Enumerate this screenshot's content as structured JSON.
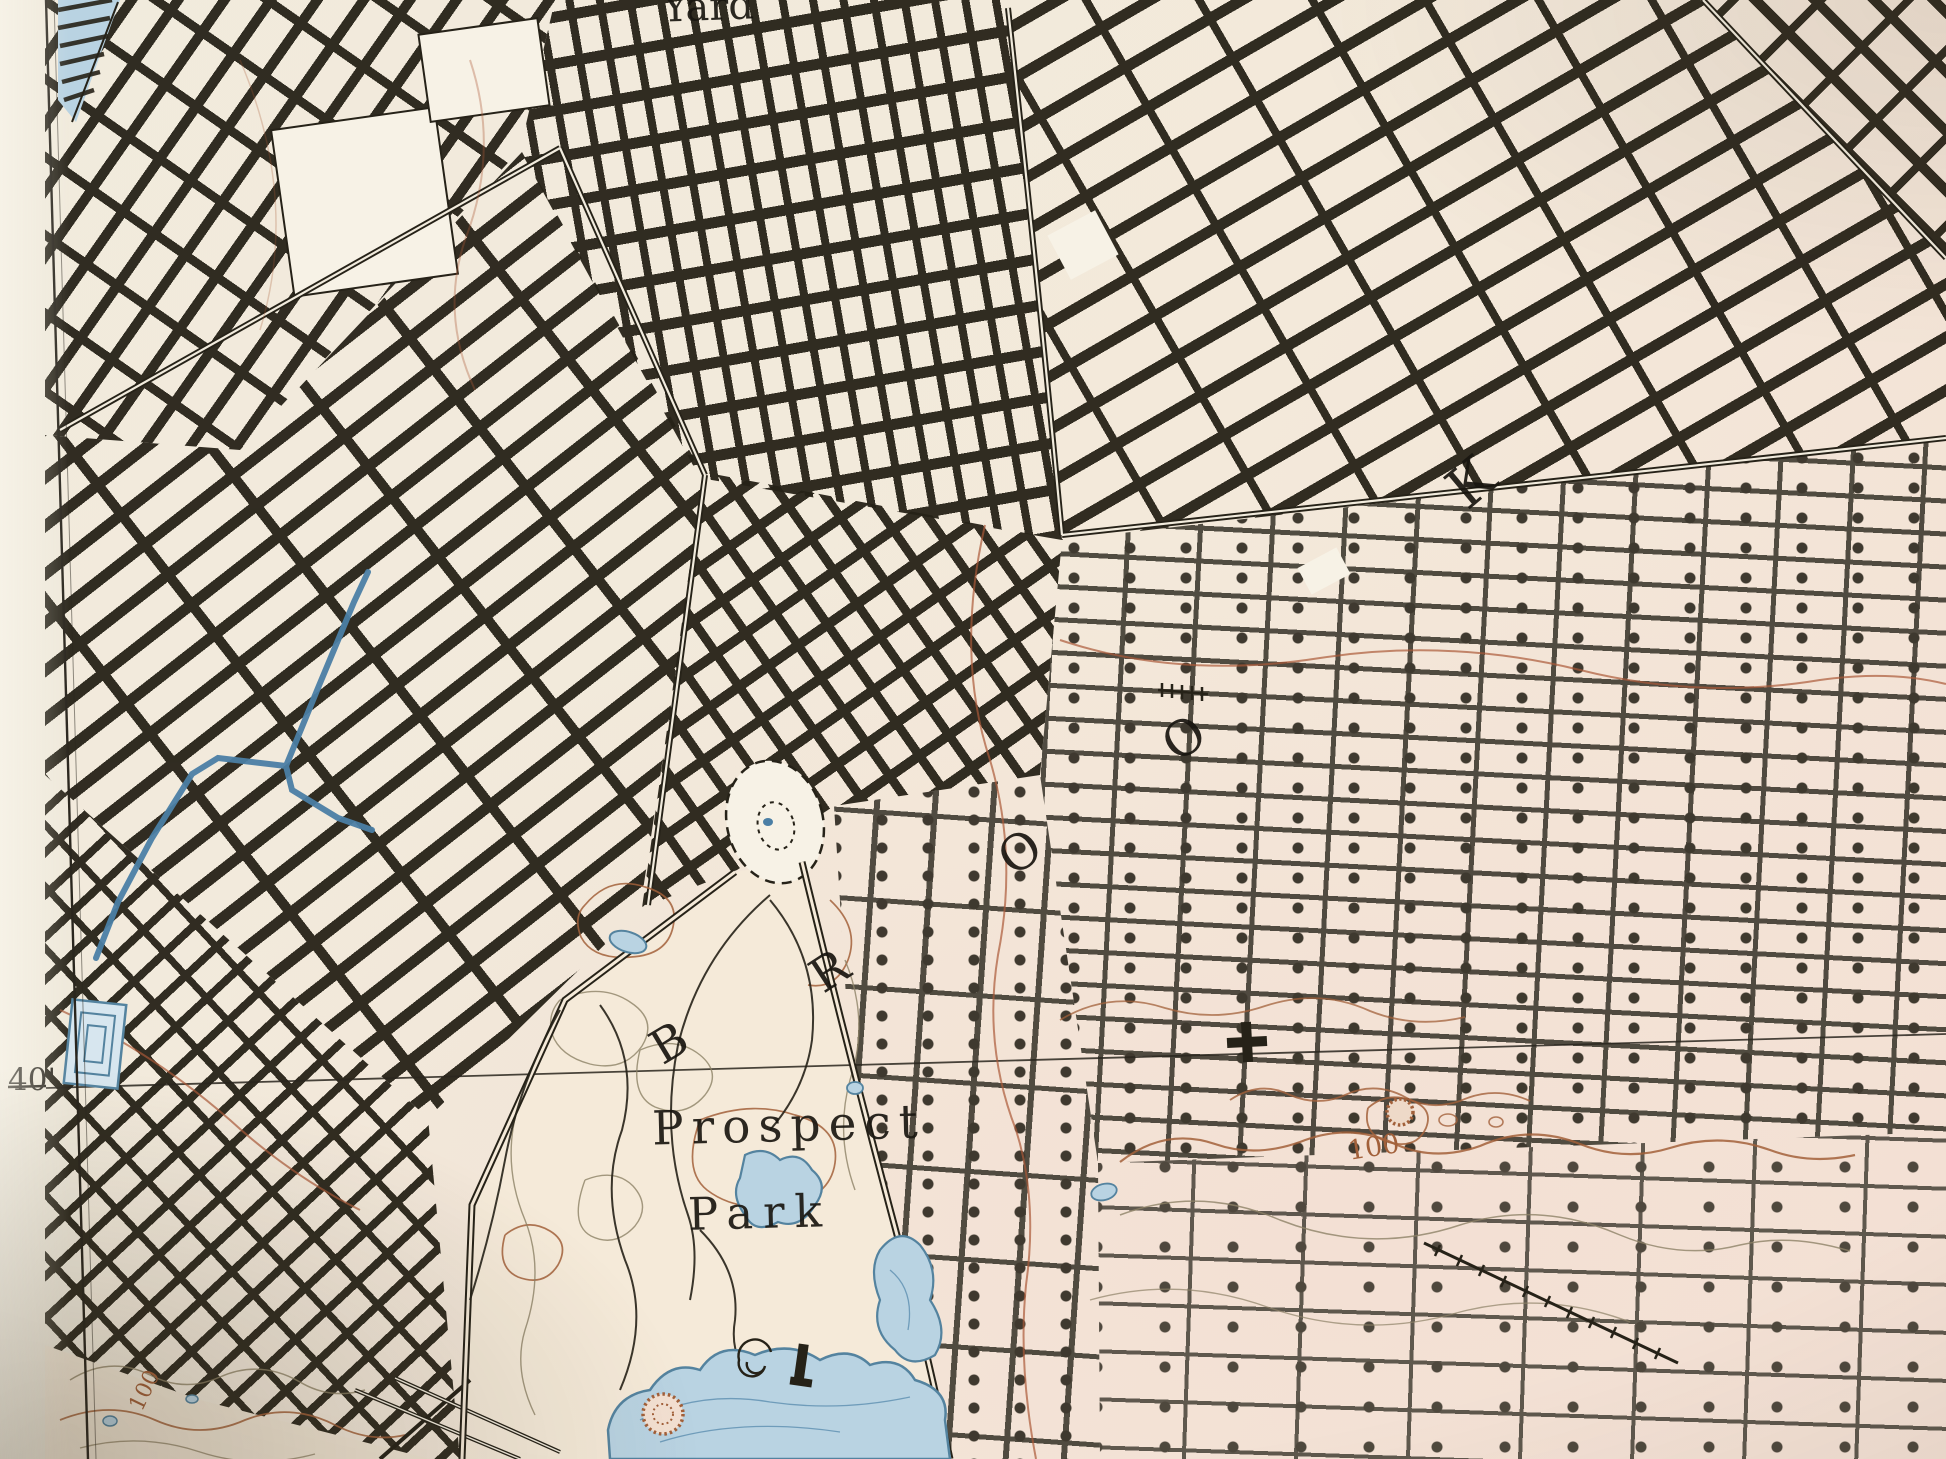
{
  "map": {
    "labels": {
      "top_cut": "Yard",
      "park_line1": "Prospect",
      "park_line2": "Park",
      "margin_latitude": "40'",
      "contour_right": "100",
      "contour_left": "100"
    },
    "place_letters": [
      {
        "char": "B"
      },
      {
        "char": "R"
      },
      {
        "char": "O"
      },
      {
        "char": "O"
      },
      {
        "char": "K"
      }
    ],
    "symbols": {
      "cross-symbol": "bold plus / church-benchmark mark",
      "spiral-path-symbol": "spiral hill path in park",
      "depression-ring-symbol": "hachured brown ring",
      "plaza-oval-symbol": "dashed oval plaza (Grand Army Plaza)",
      "railroad-ties-symbol": "line with perpendicular tie marks",
      "reservoir-symbol": "nested blue rectangles",
      "canal-symbol": "blue canal polyline",
      "piers-symbol": "blue waterfront with black piers"
    },
    "colors": {
      "ink": "#262218",
      "ink2": "#3a362c",
      "paper": "#f1ebdd",
      "paper2": "#f3e9da",
      "pink": "#f3e0d4",
      "margin": "#efe9db",
      "brown": "#a2603a",
      "red": "#ab5a38",
      "gray": "#8d8266",
      "water_fill": "#b9d3e2",
      "water_stroke": "#54839f",
      "canal": "#4b7fa5",
      "white": "#f7f2e6"
    }
  }
}
